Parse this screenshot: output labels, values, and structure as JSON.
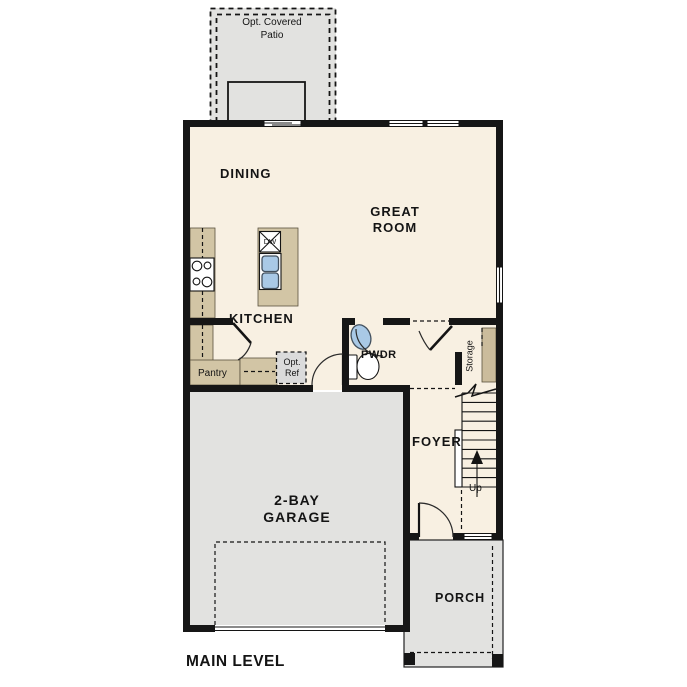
{
  "title": "MAIN LEVEL",
  "labels": {
    "patio": "Opt. Covered Patio",
    "dining": "DINING",
    "great_room": "GREAT ROOM",
    "kitchen": "KITCHEN",
    "dishwasher": "DW",
    "pwdr": "PWDR",
    "pantry": "Pantry",
    "opt_ref": "Opt. Ref",
    "storage": "Storage",
    "foyer": "FOYER",
    "up": "Up",
    "garage": "2-BAY GARAGE",
    "porch": "PORCH"
  },
  "colors": {
    "wall": "#161616",
    "floor": "#f8f0e2",
    "counter": "#d2c5a5",
    "shelf": "#cbbc9c",
    "outdoor_gray": "#e2e2e0",
    "opt_ref_gray": "#dbdbdb",
    "fixture_blue": "#a9c9e6"
  }
}
